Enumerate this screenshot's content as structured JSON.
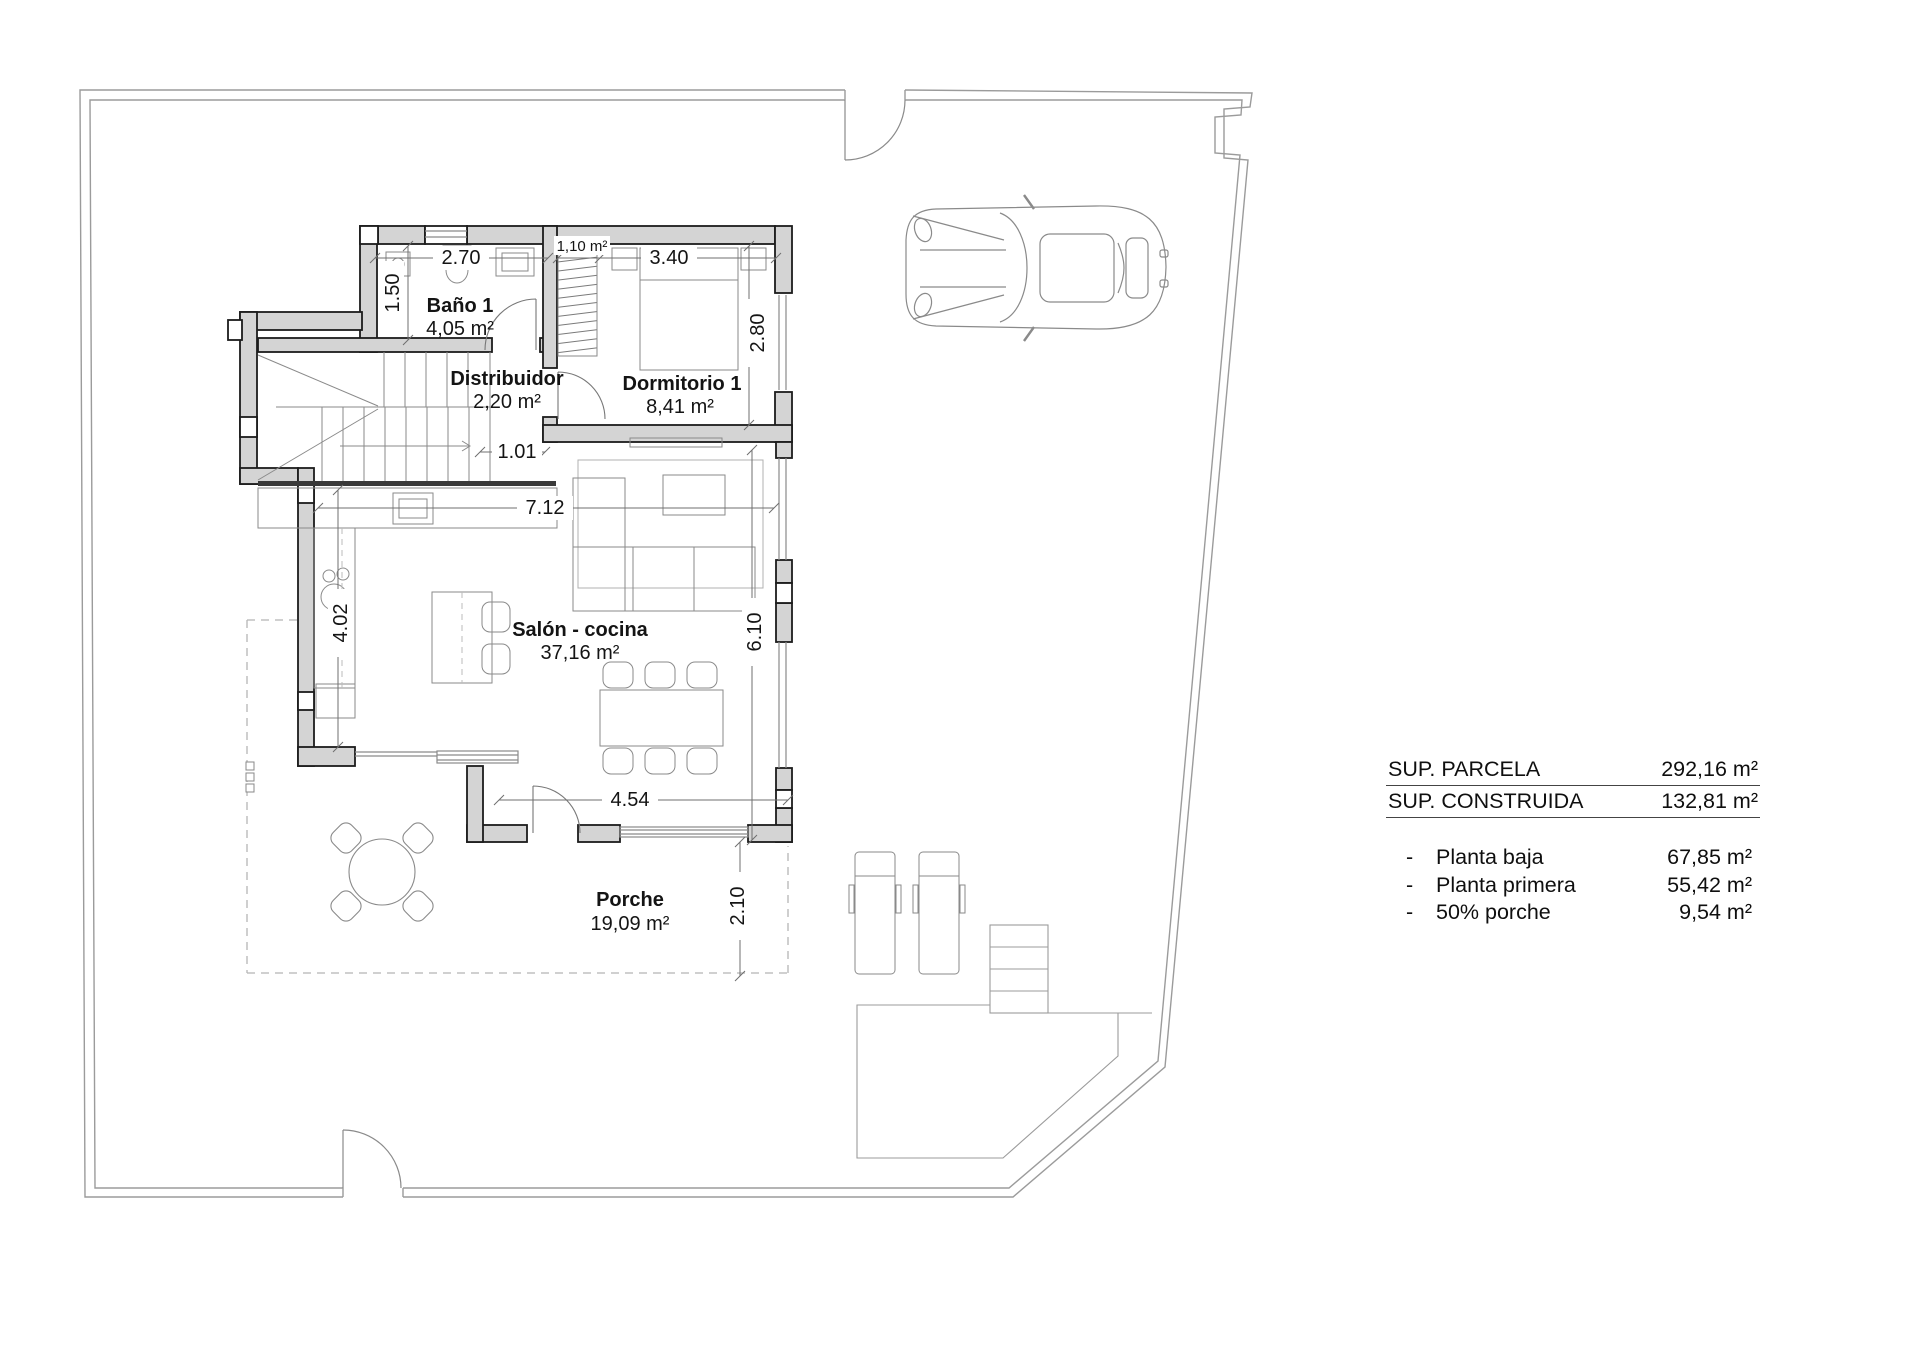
{
  "labels": {
    "bano": {
      "name": "Baño 1",
      "area": "4,05 m²"
    },
    "distribuidor": {
      "name": "Distribuidor",
      "area": "2,20 m²"
    },
    "dormitorio": {
      "name": "Dormitorio 1",
      "area": "8,41 m²"
    },
    "salon": {
      "name": "Salón - cocina",
      "area": "37,16 m²"
    },
    "porche": {
      "name": "Porche",
      "area": "19,09 m²"
    },
    "wardrobe_area": "1,10 m²"
  },
  "dims": {
    "w_bano": "2.70",
    "h_bano": "1.50",
    "w_dorm": "3.40",
    "h_dorm": "2.80",
    "w_door": "1.01",
    "w_salon": "7.12",
    "h_kitchen": "4.02",
    "h_salon": "6.10",
    "w_porch": "4.54",
    "h_porch": "2.10"
  },
  "summary": {
    "rows_main": [
      {
        "label": "SUP. PARCELA",
        "value": "292,16 m²"
      },
      {
        "label": "SUP. CONSTRUIDA",
        "value": "132,81 m²"
      }
    ],
    "rows_detail": [
      {
        "bullet": "-",
        "label": "Planta baja",
        "value": "67,85 m²"
      },
      {
        "bullet": "-",
        "label": "Planta primera",
        "value": "55,42 m²"
      },
      {
        "bullet": "-",
        "label": "50% porche",
        "value": "9,54 m²"
      }
    ]
  },
  "colors": {
    "wall_fill": "#d4d4d4",
    "wall_stroke": "#1c1c1c",
    "thin_line": "#8a8a8a",
    "boundary": "#9b9b9b",
    "text": "#141414"
  }
}
